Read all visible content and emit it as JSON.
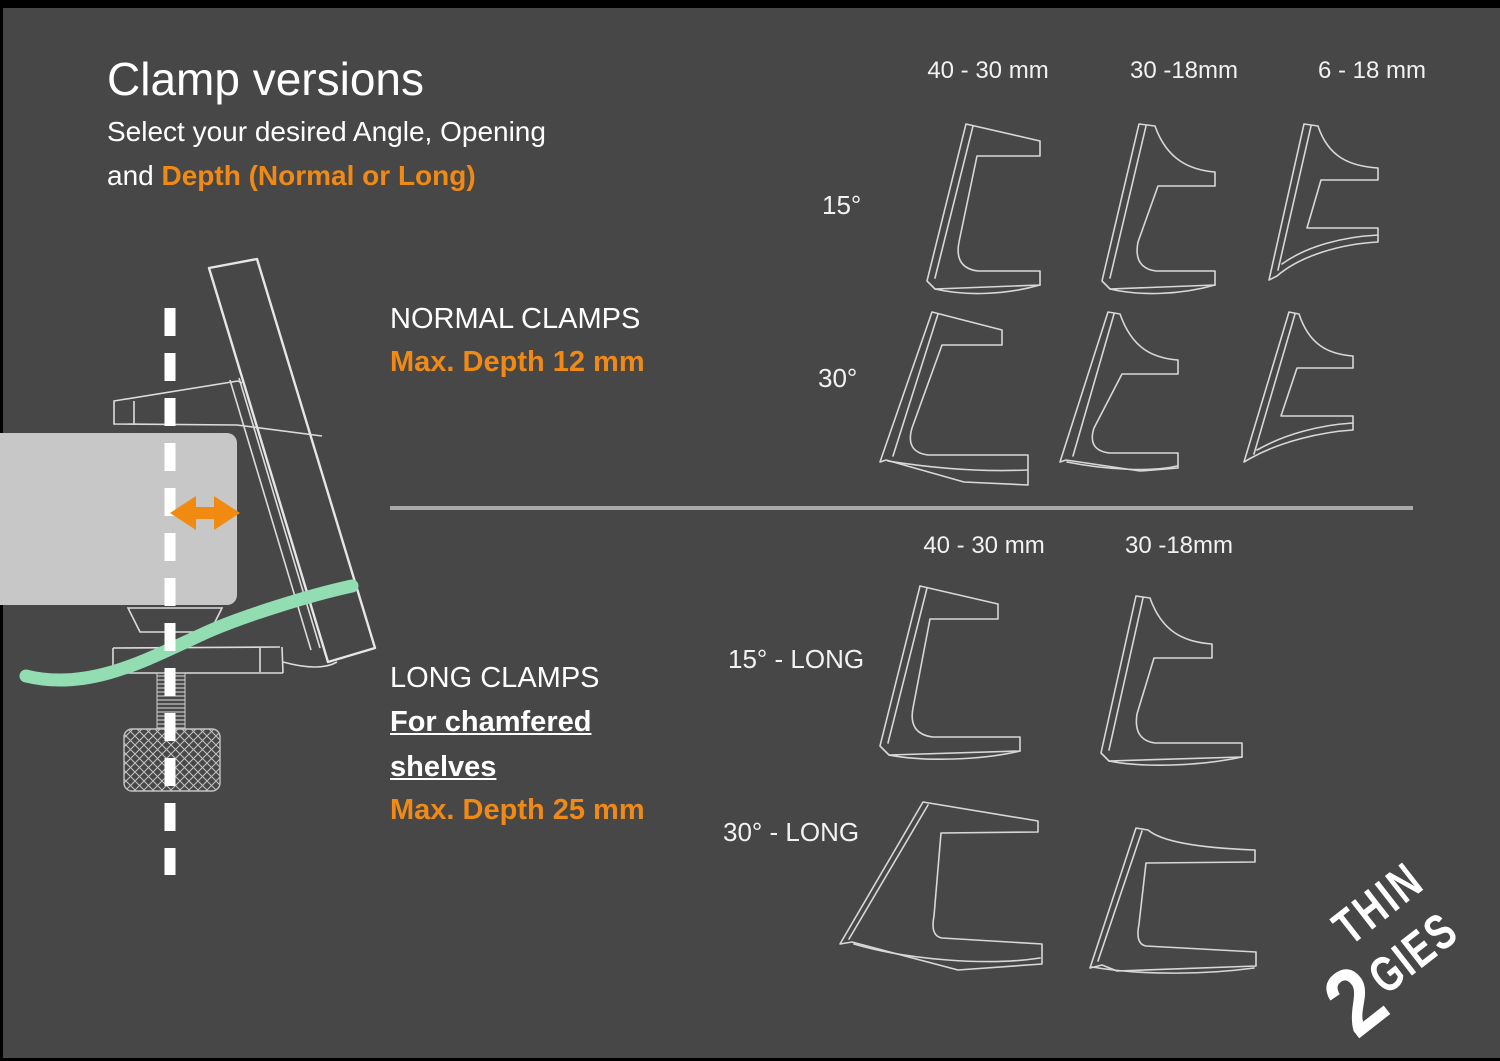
{
  "header": {
    "title": "Clamp versions",
    "subtitle_line1": "Select your desired Angle, Opening",
    "subtitle_and": "and ",
    "subtitle_highlight": "Depth (Normal or Long)"
  },
  "normal_section": {
    "heading": "NORMAL CLAMPS",
    "depth_note": "Max. Depth 12 mm",
    "columns": [
      "40 - 30 mm",
      "30 -18mm",
      "6 - 18 mm"
    ],
    "rows": [
      "15°",
      "30°"
    ]
  },
  "long_section": {
    "heading": "LONG CLAMPS",
    "chamfer_line1": "For chamfered",
    "chamfer_line2": "shelves",
    "depth_note": "Max. Depth 25 mm",
    "columns": [
      "40 - 30 mm",
      "30 -18mm"
    ],
    "rows": [
      "15° - LONG",
      "30° - LONG"
    ]
  },
  "logo": {
    "digit": "2",
    "word_top": "THIN",
    "word_bottom": "GIES"
  },
  "colors": {
    "background": "#474747",
    "accent_orange": "#F08A15",
    "cable_green": "#93DDB2",
    "line_gray": "#D8D8D8",
    "text_white": "#FFFFFF"
  }
}
